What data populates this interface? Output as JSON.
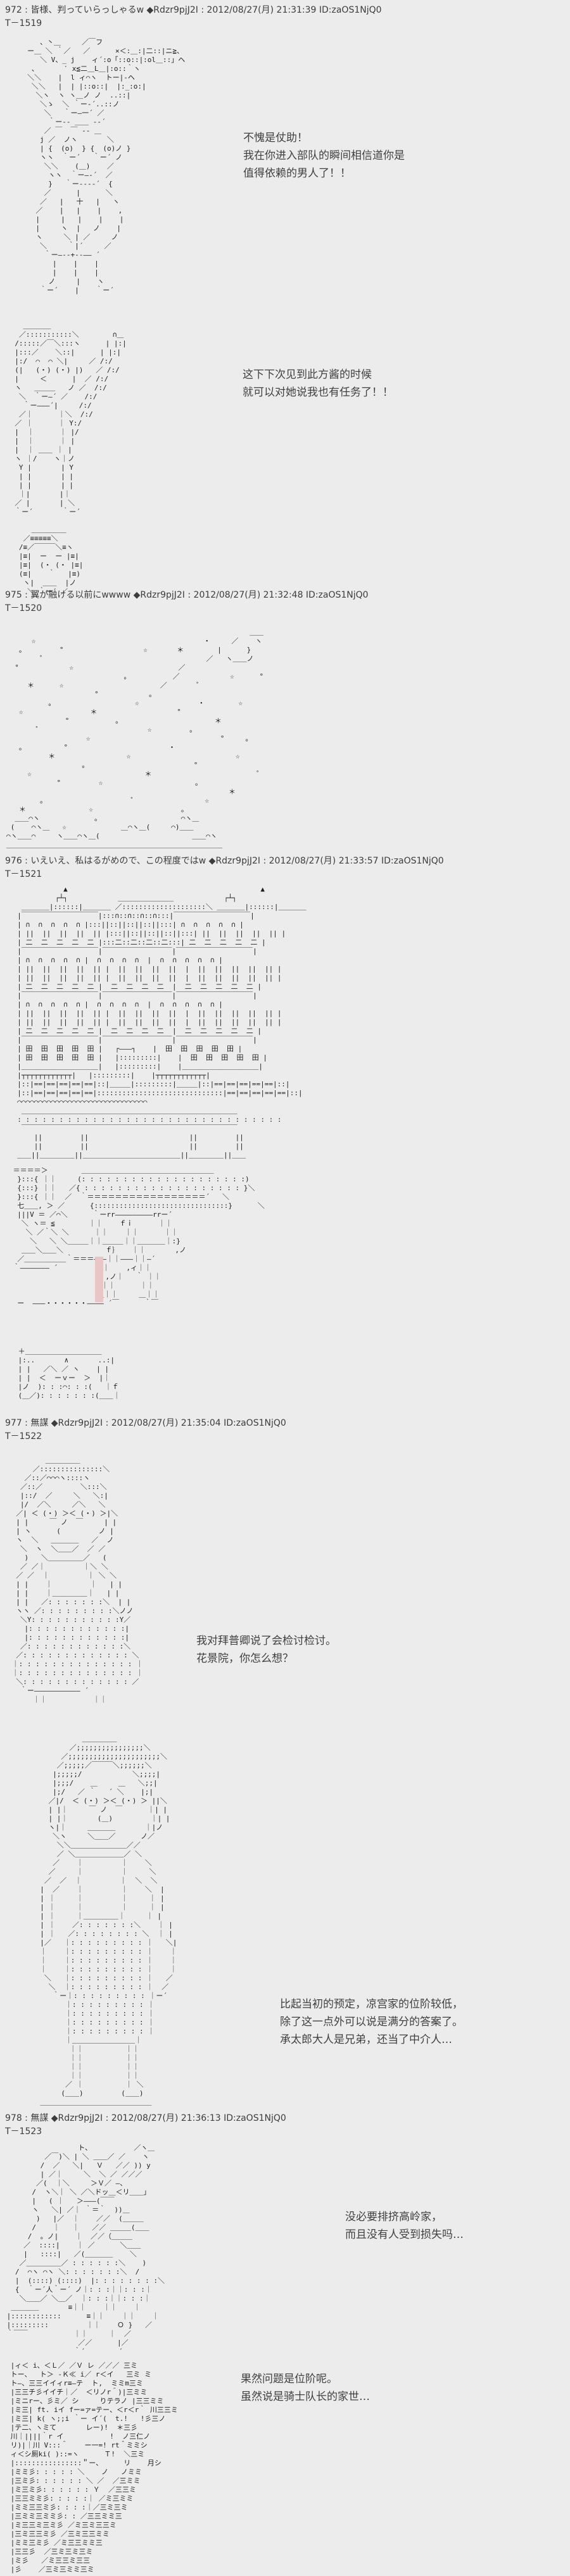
{
  "page": {
    "background_color": "#ececec",
    "text_color": "#1c1c1c",
    "accent_pink": "#e9c6c6"
  },
  "posts": [
    {
      "header": "972 : 皆様、判っていらっしゃるw ◆Rdzr9pjJ2I : 2012/08/27(月) 21:31:39 ID:zaOS1NjQ0",
      "t": "T－1519",
      "bubble1": "不愧是仗助！\n我在你进入部队的瞬间相信道你是\n值得依赖的男人了！！",
      "bubble2": "这下下次见到此方酱的时候\n就可以对她说我也有任务了！！",
      "aa": [
        "        、丶＿     ／￣フ",
        "     ー＿ ＼ ｀／   ／      ×＜:＿:|二::|ニ≧、",
        "        ＼ V、_ j    ィ´:o「::o::|:ol＿::」ヘ",
        "      、      ′ x≦二＿L＿|:o::｀ヽ",
        "     ＼＼    |  l ィ⌒ヽ  トー|-ヘ",
        "      ＼＼   |  | |::o::|  |:_:o:|",
        "       ＼ヽ  ヽ ヽ＿ノ ノ  ..::|",
        "        ＼ゝ  ＼ ｀ー‐´..::ノ",
        "         ＼   ｀ー―一´ ／",
        "          ｀ー-- ＿＿ -‐´",
        "         ／ ￣  ￣ ‐- ＿",
        "        j ／  ノヽ       ＼",
        "        | {  (о)  } {  (о)ノ }",
        "        ヽヽ  ｀ー´   ｀ー´ ノ",
        "         ＼＼    (＿)    ／",
        "          ヽヽ  ｀ー―‐´  ／",
        "          }   ｀ー---‐´  {",
        "         ／      |      ＼",
        "        ／   |   十   |   ヽ",
        "       ／    |   |    |    ,",
        "       |     |   |    |    |",
        "       |     ヽ  |   ノ    |",
        "       ヽ     ＼ | ／     ノ",
        "        ＼     ｀|´     ／",
        "         ｀ー―--+--―― ´",
        "           |    |    |",
        "           |    |    |",
        "          ノ     |    ヽ",
        "        ｀ー´    |    ｀ー´",
        "",
        "",
        "",
        "    ＿＿＿＿",
        "   ／:::::::::::＼        ∩＿",
        "  /:::::／￣＼:::ヽ      | |:|",
        "  |:::／    ＼::|      | |:|",
        "  |:/  ⌒  ⌒ ＼|     ／ /:/",
        "  (|   (・) (・) |)   ／ /:/",
        "  |     ＜      |  ／ /:/",
        "  ヽ   ＿＿＿   ノ ／  /:/",
        "   ＼  ｀ー―´ ／    /:/",
        "    ｀ー―――´|     /:/",
        "   ／｜      ｜＼  /:/",
        "  ／ ｜      ｜ Y:/",
        "  |  ｜      ｜ |/",
        "  |  ｜      ｜ |",
        "  |  ｜ ＿＿ ｜ |",
        "  ヽ ｜/    ヽ｜ノ",
        "   Y |       | Y",
        "   | |       | |",
        "   | |       | |",
        "   ｜|       |｜",
        "  ／ |       | ＼",
        "  ｀ー´       ｀ー´",
        "",
        "      ＿＿＿＿＿",
        "    ／≡≡≡≡≡＼",
        "   /≡／￣￣￣＼≡ヽ",
        "   |≡|  ー  ー |≡|",
        "   |≡|  (・ (・ |≡|",
        "   (≡|    ｀   |≡)",
        "    ヽ|  ＿＿  |ノ",
        "     ＼ ｀ー´ ／"
      ]
    },
    {
      "header": "975 : 翼が融ける以前にwwww ◆Rdzr9pjJ2I : 2012/08/27(月) 21:32:48 ID:zaOS1NjQ0",
      "t": "T－1520",
      "aa": [
        "                                                          ＿＿",
        "      ☆                                        ・     ／    ヽ",
        "   。        °                   ☆       ＊        |      }",
        "        ゜                                      ／   ヽ＿＿ノ",
        "  °            ☆                         ／",
        "                            。          ／            ☆      °",
        "     ＊      ☆                       ／       ゜",
        "                     °            ｡",
        "          。                   ☆              ・        ☆",
        "   ☆                ＊                   °",
        "              °           。                      ＊",
        "       ゜                         ☆         。",
        "                   ☆                               °     ｡",
        "   。         °                        ・",
        "          ＊                 ☆                         ☆",
        "                  。                         °",
        "     ☆                           ＊                         ゜",
        "            °         ☆                      。",
        "                                                     ＊",
        "        。                    ゜                ☆",
        "   ＊               ☆                     。",
        "  ＿＿⌒ヽ             。                   ⌒ヽ＿",
        " (    ⌒ヽ＿   ☆             ＿⌒ヽ＿(     ⌒)＿＿",
        "⌒ヽ＿＿⌒     ヽ＿＿⌒ヽ＿(                      ＿＿⌒ヽ",
        "＿＿＿＿＿＿＿＿＿＿＿＿＿＿＿＿＿＿＿＿＿＿＿＿＿＿＿＿＿＿＿"
      ]
    },
    {
      "header": "976 : いえいえ、私はるがめので、この程度ではw ◆Rdzr9pjJ2I : 2012/08/27(月) 21:33:57 ID:zaOS1NjQ0",
      "t": "T－1521",
      "aa_building": [
        "             ▲                                              ▲",
        "           ┌┴┐            ＿＿＿＿＿＿＿＿            ┌┴┐",
        "   ＿＿＿＿|::::::|＿＿＿＿ ／::::::::::::::::::::＼ ＿＿＿＿|::::::|＿＿＿＿",
        "  |￣￣￣￣￣￣￣￣￣￣￣|:::∩::∩::∩::∩:::|￣￣￣￣￣￣￣￣￣￣￣|",
        "  | ∩  ∩  ∩  ∩  ∩ |:::||::||::||::||:::| ∩  ∩  ∩  ∩  ∩ |",
        "  | ||  ||  ||  ||  || |:::||::||::||::||:::| ||  ||  ||  ||  || |",
        "  | 二  二  二  二  二 |:::二::二::二::二:::| 二  二  二  二  二 |",
        "  |￣￣￣￣￣￣￣￣￣￣￣|￣￣￣￣￣￣￣￣￣￣|￣￣￣￣￣￣￣￣￣￣￣|",
        "  | ∩  ∩  ∩  ∩  ∩ |  ∩  ∩  ∩  ∩  |  ∩  ∩  ∩  ∩  ∩ |",
        "  | ||  ||  ||  ||  || |  ||  ||  ||  ||  |  ||  ||  ||  ||  || |",
        "  | ||  ||  ||  ||  || |  ||  ||  ||  ||  |  ||  ||  ||  ||  || |",
        "  | 二  二  二  二  二 |  二  二  二  二  |  二  二  二  二  二 |",
        "  |￣￣￣￣￣￣￣￣￣￣￣|￣￣￣￣￣￣￣￣￣￣|￣￣￣￣￣￣￣￣￣￣￣|",
        "  | ∩  ∩  ∩  ∩  ∩ |  ∩  ∩  ∩  ∩  |  ∩  ∩  ∩  ∩  ∩ |",
        "  | ||  ||  ||  ||  || |  ||  ||  ||  ||  |  ||  ||  ||  ||  || |",
        "  | ||  ||  ||  ||  || |  ||  ||  ||  ||  |  ||  ||  ||  ||  || |",
        "  | 二  二  二  二  二 |  二  二  二  二  |  二  二  二  二  二 |",
        "  |￣￣￣￣￣￣￣￣￣￣￣|￣￣￣￣￣￣￣￣￣￣|￣￣￣￣￣￣￣￣￣￣￣|",
        "  | 田  田  田  田  田 |   ┌―――┐    |  田  田  田  田  田 |",
        "  | 田  田  田  田  田 |   |:::::::::|    |  田  田  田  田  田 |",
        "  |＿＿＿＿＿＿＿＿＿＿＿|   |:::::::::|    |＿＿＿＿＿＿＿＿＿＿＿|",
        "  |┬┬┬┬┬┬┬┬┬┬┬┬|   |:::::::::|    |┬┬┬┬┬┬┬┬┬┬┬┬|",
        "  |::|==|==|==|==|==|::|＿＿＿|:::::::::|＿＿＿|::|==|==|==|==|==|::|",
        "  |::|==|==|==|==|==|::::::::::::::::::::::::::::::|==|==|==|==|==|::|",
        "  ⌒⌒⌒⌒⌒⌒⌒⌒⌒⌒⌒⌒⌒⌒⌒⌒⌒⌒⌒⌒⌒⌒⌒⌒⌒⌒⌒⌒⌒⌒⌒",
        "   ＿＿＿＿＿＿＿＿＿＿＿＿＿＿＿＿＿＿＿＿＿＿＿＿＿＿＿＿＿＿＿",
        "  : : : : : : : : : : : : : : : : : : : : : : : : : : : : : : : :",
        "   ￣￣￣￣￣￣￣￣￣￣￣￣￣￣￣￣￣￣￣￣￣￣￣￣￣￣￣￣￣￣￣",
        "      ||         ||                        ||         ||",
        "      ||         ||                        ||         ||",
        "  ＿＿||＿＿＿＿＿||＿＿＿＿＿＿＿＿＿＿＿＿＿＿||＿＿＿＿＿||＿＿"
      ],
      "aa_hall": [
        " ＝＝＝＝＞        ＿＿＿＿＿＿＿＿＿＿＿＿＿＿＿＿＿＿＿",
        "  }:::{ ｜｜     (: : : : : : : : : : : : : : : : : : : :)",
        "  {:::} ｜｜   ／{ : : : : : : : : : : : : : : : : : : : }＼",
        "  }:::{ ｜｜  ／  ｀＝＝＝＝＝＝＝＝＝＝＝＝＝＝＝＝＝´   ＼",
        "  七＿＿, ＞ ／      {::::::::::::::::::::::::::::::::}      ＼",
        "  |||V ＝ ／⌒＼      ｀ーrr―――――――――rrー´",
        "   ＼ ヽ＝ ≦        ｜｜    ｆｉ      ｜｜",
        "    ＼ ／｀＼ ＼      ｜｜    ｜｜      ｜｜",
        "     ＼   ＼ ＼＿＿＿｜｜＿＿＿｜｜＿＿＿＿｜:}",
        "   ＿＿＼＿＿＼          ｆ｝   ｜｜       ,ノ",
        "  ／＿＿＿＿＿＿｀＝＝＝―――｜｜―――｜｜―´",
        " ｀――――――― ´         ｜｜    ,ィ｜｜",
        "                       ,ノ｜   ｀ ｜｜",
        "                      ｜｜      ｜｜",
        "                     ＿｜｜     ＿｜｜",
        "  ー  ―――・・・・・・―――― ´￣      ｀￣"
      ],
      "aa_portrait": [
        " ＋＿＿＿＿＿＿＿＿＿＿＿",
        " |:..       ∧       ..:|",
        " | |   ／＼ ／ ヽ    | |",
        " | |  ＜  ーｖー  ＞  |｜",
        " |ノ  ): : :⌒: : :(   ｜ｆ",
        " (＿／): : : : : : :(＿＿｜"
      ]
    },
    {
      "header": "977 : 無謀 ◆Rdzr9pjJ2I : 2012/08/27(月) 21:35:04 ID:zaOS1NjQ0",
      "t": "T－1522",
      "bubble1": "我对拜普卿说了会检讨检讨。\n花景院，你怎么想？",
      "bubble2": "比起当初的预定，凉宫家的位阶较低，\n除了这一点外可以说是满分的答案了。\n承太郎大人是兄弟，还当了中介人…",
      "aa_lady": [
        "         ＿＿＿＿＿",
        "      ／:::::::::::::::＼",
        "    ／::／⌒⌒⌒ヽ::::ヽ",
        "   ／::／         ＼:::＼",
        "   |::/  ／     ＼   ＼:|",
        "   |/  ／＼     ／＼   ＼",
        "  ／| ＜ (・) ＞＜ (・) ＞|＼",
        "  | |     ￣ ノ  ￣     | |",
        "  | ヽ      (         ノ |",
        "  ヽ  ＼   ＿＿＿＿   ／  ノ",
        "   ＼  ヽ  ＼＿＿／  ／ ／",
        "    )   ＼＿＿＿＿＿／   (",
        "   ／ ／｜         ｜＼ ＼",
        "  ／ ／  ｜         ｜ ＼ ＼",
        "  | |    ｜         ｜   | |",
        "  | |    ｜＿＿＿＿＿｜   | |",
        "  | |   ／: : : : : : :＼  | |",
        "  ヽヽ ／: : : : : : : : :＼ノノ",
        "   ＼Y: : : : : : : : : : :Y／",
        "    |: : : : : : : : : : : :|",
        "    |: : : : : : : : : : : :|",
        "   ／: : : : : : : : : : : :＼",
        "  ／: : : : : : : : : : : : : ＼",
        " ｜: : : : : : : : : : : : : : ｜",
        " ｜: : : : : : : : : : : : : : ｜",
        "  ＼: : : : : : : : : : : : : ／",
        "   ｀ー――――――――――― ´",
        "      ｜｜           ｜｜"
      ],
      "aa_man": [
        "            ＿＿＿＿＿",
        "         ／;;;;;;;;;;;;;;;;＼",
        "       ／;;;;;;;;;;;;;;;;;;;;;;＼",
        "      ／;;;;;／￣￣￣＼;;;;;;＼",
        "     |;;;;;/            ＼;;;;|",
        "     |;;;/    ＿     ＿   ＼;;|",
        "     |;/   ／ ｀   ´ ＼    |;|",
        "    ／|/  ＜ (・) ＞＜ (・) ＞ ||＼",
        "    | |｜     ￣ ノ  ￣      ｜| |",
        "    | |｜       (＿)         ｜| |",
        "    ヽ|｜     ＿＿＿＿       ｜|ノ",
        "     ＼ヽ     ＼＿＿／      ノ／",
        "      ＼＼＿＿＿＿＿＿＿＿／／",
        "      ／ ＼＿＿＿＿＿＿＿／ ＼",
        "     ／    ｜         ｜    ＼",
        "    ／     ｜         ｜     ＼",
        "   ／  ／  ｜         ｜  ＼  ＼",
        "  |  ／    ｜         ｜    ＼  |",
        "  | ｜     ｜         ｜     ｜ |",
        "  | ｜     ｜         ｜     ｜ |",
        "  | ｜     ｜＿＿＿＿＿｜     ｜ |",
        "  | ｜    ／: : : : : : :＼    ｜ |",
        "  | ｜   ／: : : : : : : : ＼  ｜ |",
        "  |／   ｜: : : : : : : : : ｜   ＼|",
        "  ｜    ｜: : : : : : : : : ｜    ｜",
        "  ｜    ｜: : : : : : : : : ｜    ｜",
        "  ｜    ｜: : : : : : : : : ｜    ｜",
        "   ＼   ｜: : : : : : : : : ｜   ／",
        "    ＼  ｜: : : : : : : : : ｜  ／",
        "     ｀ー｜: : : : : : : : : ｜ー´",
        "        ｜: : : : : : : : : ｜",
        "        ｜: : : : : : : : : ｜",
        "        ｜: : : : : : : : : ｜",
        "        ｜: : : : : : : : : ｜",
        "        ｜＿＿＿＿＿＿＿＿＿｜",
        "         ｜｜          ｜｜",
        "         ｜｜          ｜｜",
        "         ｜｜          ｜｜",
        "         ｜｜          ｜｜",
        "        ／ ｜          ｜ ＼",
        "       (＿＿)         (＿＿)",
        "  ＿＿＿＿＿＿＿＿＿＿＿＿＿＿＿＿"
      ]
    },
    {
      "header": "978 : 無謀 ◆Rdzr9pjJ2I : 2012/08/27(月) 21:36:13 ID:zaOS1NjQ0",
      "t": "T－1523",
      "bubble1": "没必要排挤高岭家，\n而且没有人受到损失吗…",
      "bubble2": "果然问题是位阶呢。\n虽然说是骑士队长的家世…",
      "aa_horse": [
        "                  ト、          ／ヽ＿",
        "          ／￣)＼ | ＼ ＿＿／ ／    ヽ",
        "         /  ／   ＼|   Ｖ   ／／ )) y",
        "         | ／｜     ＼  ＼ ／ ／／／",
        "        ／(  ｜＼     ＞Ｖ／ ―、",
        "       /  ヽ＼｜ ＼ ／＼ドッ＿＜リ＿＿」",
        "       |   ( ｜   ＞―――(￣￣",
        "       ヽ   ＼| ／｜ ｀＝｀  ))＿",
        "        )   |／  ｜    ／／  (＿＿＿",
        "       /    ｜   ｜   ／／ ＿＿＿(＿＿",
        "      /  。ノ|    ｜  ／／（＿＿＿",
        "     ／  ::::|    ｜ ／      ＼＿＿",
        "     |   ::::|   ／(＿＿＿＿    ＼",
        "    ／＿＿＿＿＿／ : : : : : :＼    )",
        "   /  ⌒ヽ ⌒ヽ ＼: : : : : : :＼  /",
        "   |  (::::) (::::)  |: : : : : : : :＼",
        "   {  ｀ー´人｀ー´ ノ｜: : :｜｜: : :｜",
        "    ＼＿＿／ ＼＿／  ｜: : :｜｜: : :｜",
        "  ＿＿＿＿       ≡｜｜    ｜｜    ｜",
        " |::::::::::::      ≡｜｜    ｜｜    ｜",
        " |:::::::::         ｜｜    Ｏ }   ／",
        " ｀￣￣           ｜｜     ｜  ／",
        "                  ／／      |／",
        "                 ｀´        ´"
      ],
      "aa_face": [
        " |ィ＜ i、＜Ｌ／ ／Ｖ レ ／／／ 三ミ",
        " トー、  ト＞ -Ｋ≪ i／ r＜イ   三ミ ミ",
        " ト―、三三イイィr≡―テ  ト,  ミミm三ミ",
        " |三三チ彡イイチ｜／  ＜リノr＾)|三ミミ",
        " |ミニrー、彡ミ／ シ     りテラノ |三三ミミ",
        " |ミ三| ft. iイ fー=ァ=テー、＜r＜r｀ 川三三ミ",
        " |ミ三| k( ヽ;;i ｀ー イ´(  t.!   !彡三ノ",
        " |テ二、ヽミて       レー)!  ＊三彡",
        " 川｜||||｀r イ           !  ノ三仁ノ",
        " リ)|｜川 V:::＾    ー一=! rt＾ミミシ",
        " ィ＜シ厠ki( )::=ヽ      Ｔ!  ＼三ミ",
        " |::::::::::::::::＂ー、     リ    月シ",
        " |ミミ彡: : : : : ＼    ノ   ノミミ",
        " |三ミ彡: : : : : : ＼ ／  ／三ミミ",
        " |ミ三ミ彡: : : : : : Ｙ  ／三三ミ",
        " |三三ミミ彡: : : : :｜ ／ミ三ミミ",
        " |ミミ三三ミ彡: : : :｜／三ミ三ミ",
        " |三ミミ三ミミ彡: : ／三三ミミ三",
        " |ミ三三ミ三ミ彡 ／ミ三ミ三三ミ",
        " |三ミ三三ミ彡 ／三ミ三三ミミ",
        " |ミミ三ミ彡 ／ミ三三ミミ三",
        " |三三彡  ／三ミ三ミ三ミ",
        " |ミ彡   ／ミ三三ミ三三",
        " |彡    ／三ミ三ミミ三ミ"
      ]
    }
  ]
}
